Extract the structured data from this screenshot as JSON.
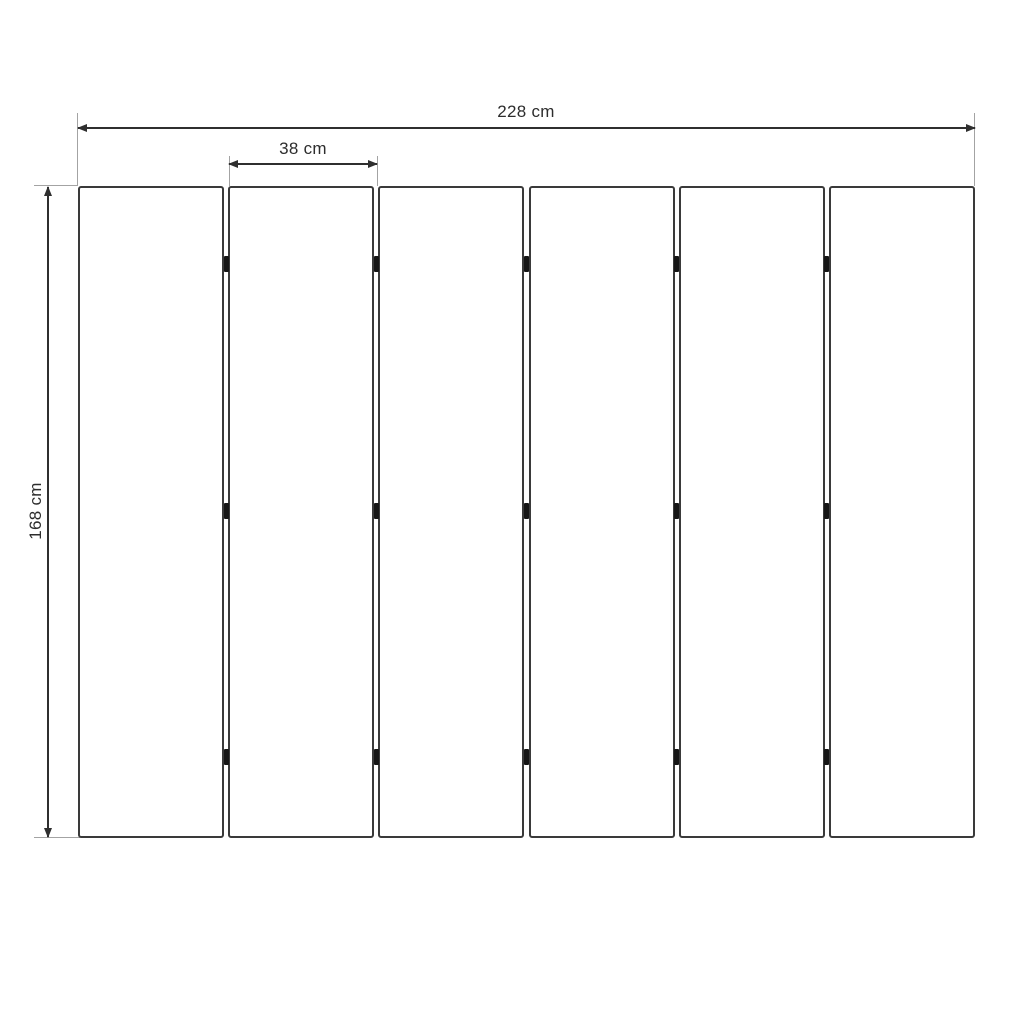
{
  "diagram": {
    "kind": "technical-dimension-drawing",
    "subject": "six-panel folding screen with hinges",
    "panel_count": 6,
    "hinge_columns": 5,
    "hinge_rows": 3,
    "dimensions": {
      "total_width": {
        "label": "228 cm",
        "value": 228,
        "unit": "cm"
      },
      "panel_width": {
        "label": "38 cm",
        "value": 38,
        "unit": "cm"
      },
      "height": {
        "label": "168 cm",
        "value": 168,
        "unit": "cm"
      }
    },
    "colors": {
      "background": "#ffffff",
      "panel_outline": "#3a3a3a",
      "dimension_line": "#2f2f2f",
      "extension_line": "#a3a3a3",
      "hinge": "#161616",
      "text": "#2d2d2d"
    }
  }
}
